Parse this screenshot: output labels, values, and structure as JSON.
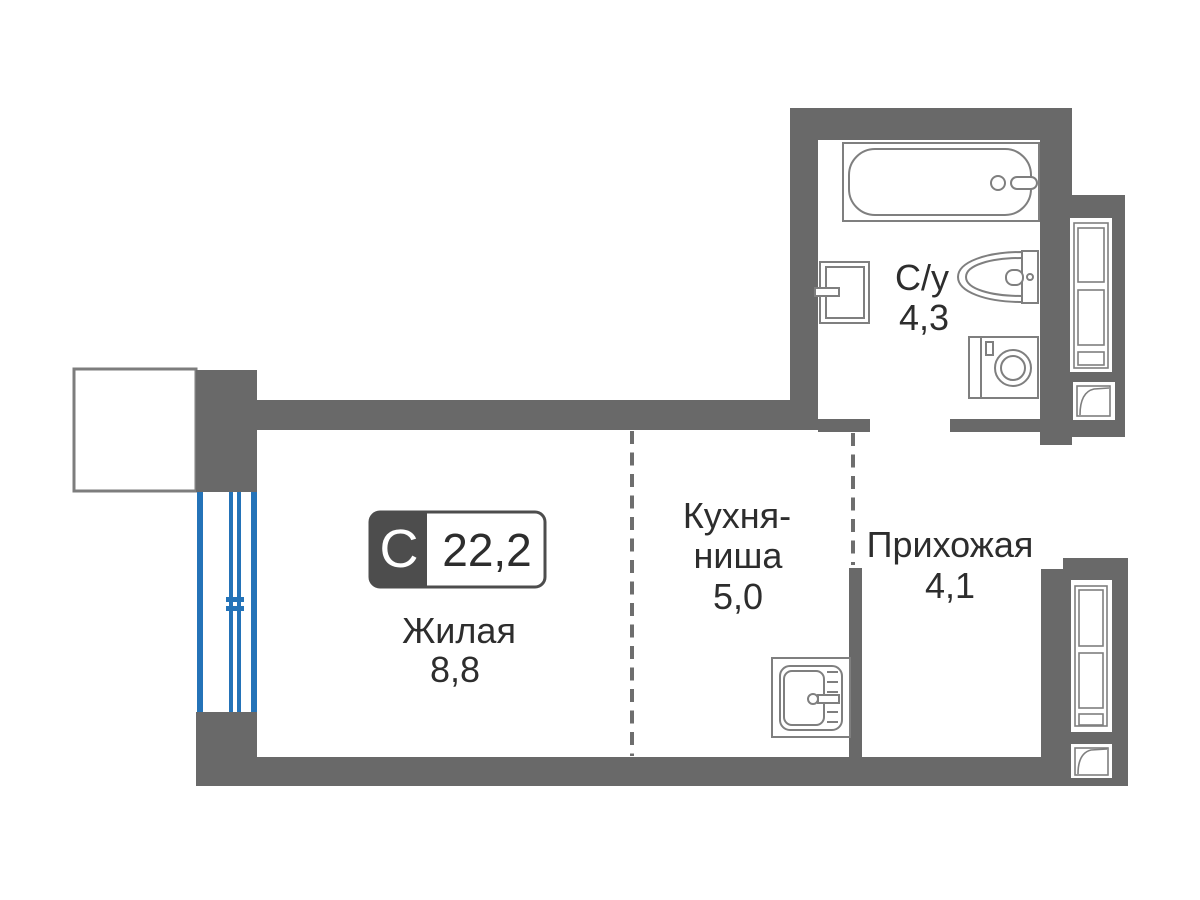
{
  "plan": {
    "badge": {
      "letter": "С",
      "total_area": "22,2"
    },
    "rooms": {
      "living": {
        "name": "Жилая",
        "area": "8,8"
      },
      "kitchen": {
        "name_line1": "Кухня-",
        "name_line2": "ниша",
        "area": "5,0"
      },
      "hallway": {
        "name": "Прихожая",
        "area": "4,1"
      },
      "bathroom": {
        "name": "С/у",
        "area": "4,3"
      }
    },
    "colors": {
      "wall": "#696969",
      "badge_dark": "#4d4d4d",
      "window_blue": "#2473b8",
      "fixture_stroke": "#7f7f7f",
      "balcony_stroke": "#7d7d7d",
      "dash": "#6e6e6e",
      "text": "#2d2d2d"
    }
  }
}
